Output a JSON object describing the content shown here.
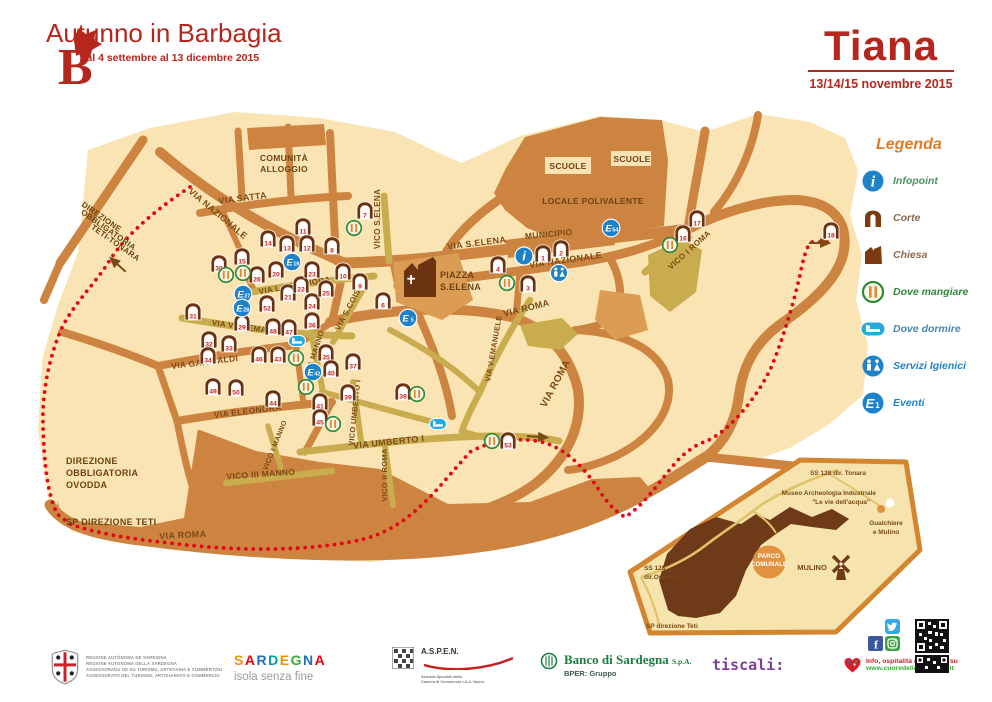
{
  "theme": {
    "red": "#b5261d",
    "map_base": "#fbe4b3",
    "road": "#cd8440",
    "olive": "#c9ac4e",
    "dark_brown": "#6b3310",
    "text_brown": "#7b4a15",
    "boundary": "#e30613",
    "blue": "#1e82c8",
    "light_blue": "#29a8e0",
    "green": "#2e8b3a",
    "utensil": "#e08a2e",
    "legend_orange": "#e07b27",
    "inset_park": "#6e3a17",
    "inset_fill": "#f6e3ae",
    "accent_orange": "#e2923f",
    "number_red": "#cc1f1f"
  },
  "header": {
    "logo_letter": "B",
    "title": "Autunno in Barbagia",
    "subtitle": "dal 4 settembre al 13 dicembre 2015",
    "town": "Tiana",
    "dates": "13/14/15 novembre 2015"
  },
  "legend": {
    "title": "Legenda",
    "items": [
      {
        "id": "infopoint",
        "label": "Infopoint",
        "color": "#4b9464"
      },
      {
        "id": "corte",
        "label": "Corte",
        "color": "#8a6a50"
      },
      {
        "id": "chiesa",
        "label": "Chiesa",
        "color": "#8a6a50"
      },
      {
        "id": "mangiare",
        "label": "Dove mangiare",
        "color": "#2e8b3a"
      },
      {
        "id": "dormire",
        "label": "Dove dormire",
        "color": "#4a86b0"
      },
      {
        "id": "servizi",
        "label": "Servizi Igienici",
        "color": "#1e82c8"
      },
      {
        "id": "eventi",
        "label": "Eventi",
        "color": "#1e82c8"
      }
    ]
  },
  "map": {
    "street_labels": [
      {
        "t": "VIA SATTA",
        "x": 243,
        "y": 201,
        "r": -7,
        "s": 9
      },
      {
        "t": "VIA NAZIONALE",
        "x": 216,
        "y": 216,
        "r": 40,
        "s": 9
      },
      {
        "t": "VIA S.ELENA",
        "x": 477,
        "y": 246,
        "r": -7,
        "s": 9
      },
      {
        "t": "MUNICIPIO",
        "x": 549,
        "y": 237,
        "r": -5,
        "s": 8.5
      },
      {
        "t": "VIA NAZIONALE",
        "x": 566,
        "y": 263,
        "r": -8,
        "s": 9
      },
      {
        "t": "VIA ROMA",
        "x": 527,
        "y": 311,
        "r": -14,
        "s": 9
      },
      {
        "t": "VIA ROMA",
        "x": 558,
        "y": 385,
        "r": -62,
        "s": 10
      },
      {
        "t": "VIA ROMA",
        "x": 183,
        "y": 538,
        "r": -3,
        "s": 9
      },
      {
        "t": "VIA LAMARMORA",
        "x": 295,
        "y": 288,
        "r": -10,
        "s": 8
      },
      {
        "t": "VIA VITT.EMANUELE",
        "x": 253,
        "y": 331,
        "r": 8,
        "s": 8
      },
      {
        "t": "VIA S.COIS",
        "x": 350,
        "y": 311,
        "r": -62,
        "s": 8
      },
      {
        "t": "VIA GARIBALDI",
        "x": 205,
        "y": 365,
        "r": -7,
        "s": 8.5
      },
      {
        "t": "VIA ELEONORA",
        "x": 248,
        "y": 414,
        "r": -7,
        "s": 8.5
      },
      {
        "t": "VIA UMBERTO I",
        "x": 389,
        "y": 445,
        "r": -6,
        "s": 9
      },
      {
        "t": "VICO III MANNO",
        "x": 261,
        "y": 477,
        "r": -4,
        "s": 8.5
      },
      {
        "t": "VICO II ROMA",
        "x": 387,
        "y": 475,
        "r": -90,
        "s": 7.5
      },
      {
        "t": "VICO UMBERTO I",
        "x": 357,
        "y": 413,
        "r": -84,
        "s": 7.5
      },
      {
        "t": "VIA MANNO",
        "x": 317,
        "y": 353,
        "r": -72,
        "s": 7.5
      },
      {
        "t": "VICO I MANNO",
        "x": 277,
        "y": 446,
        "r": -68,
        "s": 7
      },
      {
        "t": "VICO S.ELENA",
        "x": 380,
        "y": 219,
        "r": -90,
        "s": 8
      },
      {
        "t": "VIA V.EMANUELE",
        "x": 496,
        "y": 349,
        "r": -80,
        "s": 7.5
      },
      {
        "t": "VICO I ROMA",
        "x": 691,
        "y": 252,
        "r": -42,
        "s": 8
      }
    ],
    "area_labels": [
      {
        "t": "COMUNITÀ",
        "x": 284,
        "y": 161,
        "s": 8.5
      },
      {
        "t": "ALLOGGIO",
        "x": 284,
        "y": 172,
        "s": 8.5
      },
      {
        "t": "SCUOLE",
        "x": 568,
        "y": 169,
        "s": 8.5
      },
      {
        "t": "SCUOLE",
        "x": 632,
        "y": 162,
        "s": 8.5
      },
      {
        "t": "LOCALE POLIVALENTE",
        "x": 593,
        "y": 204,
        "s": 8.5
      },
      {
        "t": "PIAZZA",
        "x": 440,
        "y": 278,
        "s": 9,
        "a": "start"
      },
      {
        "t": "S.ELENA",
        "x": 440,
        "y": 290,
        "s": 9,
        "a": "start"
      },
      {
        "t": "DIREZIONE",
        "x": 100,
        "y": 219,
        "s": 8,
        "r": 35
      },
      {
        "t": "OBBLIGATORIA",
        "x": 107,
        "y": 232,
        "s": 8,
        "r": 35
      },
      {
        "t": "TETI-TONARA",
        "x": 114,
        "y": 245,
        "s": 8,
        "r": 35
      },
      {
        "t": "DIREZIONE",
        "x": 66,
        "y": 464,
        "s": 9,
        "a": "start"
      },
      {
        "t": "OBBLIGATORIA",
        "x": 66,
        "y": 476,
        "s": 9,
        "a": "start"
      },
      {
        "t": "OVODDA",
        "x": 66,
        "y": 488,
        "s": 9,
        "a": "start"
      },
      {
        "t": "SP DIREZIONE TETI",
        "x": 66,
        "y": 525,
        "s": 9,
        "a": "start"
      }
    ],
    "corte": [
      {
        "n": "1",
        "x": 543,
        "y": 253
      },
      {
        "n": "2",
        "x": 561,
        "y": 248
      },
      {
        "n": "3",
        "x": 528,
        "y": 283
      },
      {
        "n": "4",
        "x": 498,
        "y": 264
      },
      {
        "n": "6",
        "x": 383,
        "y": 300
      },
      {
        "n": "7",
        "x": 365,
        "y": 210
      },
      {
        "n": "8",
        "x": 332,
        "y": 245
      },
      {
        "n": "9",
        "x": 360,
        "y": 281
      },
      {
        "n": "10",
        "x": 343,
        "y": 271
      },
      {
        "n": "11",
        "x": 303,
        "y": 226
      },
      {
        "n": "12",
        "x": 307,
        "y": 243
      },
      {
        "n": "13",
        "x": 287,
        "y": 243
      },
      {
        "n": "14",
        "x": 268,
        "y": 238
      },
      {
        "n": "15",
        "x": 242,
        "y": 256
      },
      {
        "n": "16",
        "x": 683,
        "y": 233
      },
      {
        "n": "17",
        "x": 697,
        "y": 218
      },
      {
        "n": "18",
        "x": 831,
        "y": 230
      },
      {
        "n": "20",
        "x": 276,
        "y": 269
      },
      {
        "n": "21",
        "x": 288,
        "y": 292
      },
      {
        "n": "22",
        "x": 301,
        "y": 284
      },
      {
        "n": "23",
        "x": 312,
        "y": 269
      },
      {
        "n": "24",
        "x": 312,
        "y": 301
      },
      {
        "n": "25",
        "x": 326,
        "y": 288
      },
      {
        "n": "26",
        "x": 257,
        "y": 274
      },
      {
        "n": "29",
        "x": 242,
        "y": 322
      },
      {
        "n": "30",
        "x": 219,
        "y": 263
      },
      {
        "n": "31",
        "x": 193,
        "y": 311
      },
      {
        "n": "32",
        "x": 209,
        "y": 339
      },
      {
        "n": "33",
        "x": 229,
        "y": 343
      },
      {
        "n": "34",
        "x": 208,
        "y": 355
      },
      {
        "n": "35",
        "x": 326,
        "y": 352
      },
      {
        "n": "36",
        "x": 312,
        "y": 320
      },
      {
        "n": "37",
        "x": 353,
        "y": 361
      },
      {
        "n": "38",
        "x": 403,
        "y": 391
      },
      {
        "n": "39",
        "x": 348,
        "y": 392
      },
      {
        "n": "40",
        "x": 331,
        "y": 368
      },
      {
        "n": "41",
        "x": 320,
        "y": 401
      },
      {
        "n": "43",
        "x": 278,
        "y": 354
      },
      {
        "n": "44",
        "x": 273,
        "y": 398
      },
      {
        "n": "45",
        "x": 320,
        "y": 417
      },
      {
        "n": "46",
        "x": 259,
        "y": 354
      },
      {
        "n": "47",
        "x": 289,
        "y": 327
      },
      {
        "n": "48",
        "x": 273,
        "y": 326
      },
      {
        "n": "49",
        "x": 213,
        "y": 386
      },
      {
        "n": "50",
        "x": 236,
        "y": 387
      },
      {
        "n": "52",
        "x": 267,
        "y": 303
      },
      {
        "n": "53",
        "x": 508,
        "y": 440
      }
    ],
    "events": [
      {
        "n": "5",
        "x": 408,
        "y": 318
      },
      {
        "n": "19",
        "x": 292,
        "y": 262
      },
      {
        "n": "27",
        "x": 243,
        "y": 294
      },
      {
        "n": "28",
        "x": 242,
        "y": 308
      },
      {
        "n": "42",
        "x": 313,
        "y": 372
      },
      {
        "n": "54",
        "x": 611,
        "y": 228
      }
    ],
    "eat": [
      {
        "x": 354,
        "y": 228
      },
      {
        "x": 226,
        "y": 275
      },
      {
        "x": 243,
        "y": 273
      },
      {
        "x": 507,
        "y": 283
      },
      {
        "x": 296,
        "y": 358
      },
      {
        "x": 306,
        "y": 387
      },
      {
        "x": 333,
        "y": 424
      },
      {
        "x": 417,
        "y": 394
      },
      {
        "x": 492,
        "y": 441
      },
      {
        "x": 670,
        "y": 245
      }
    ],
    "sleep": [
      {
        "x": 297,
        "y": 341
      },
      {
        "x": 438,
        "y": 424
      }
    ],
    "wc": [
      {
        "x": 559,
        "y": 273
      }
    ],
    "info": [
      {
        "x": 524,
        "y": 256
      }
    ]
  },
  "inset": {
    "labels": [
      {
        "t": "SS 128 dir. Tonara",
        "x": 838,
        "y": 475,
        "s": 6.5
      },
      {
        "t": "Museo Archeologia Industriale",
        "x": 876,
        "y": 495,
        "s": 6.5,
        "a": "end"
      },
      {
        "t": "\"Le vie dell'acqua\"",
        "x": 870,
        "y": 504,
        "s": 6.5,
        "a": "end"
      },
      {
        "t": "Gualchiere",
        "x": 886,
        "y": 525,
        "s": 6.5
      },
      {
        "t": "e Mulino",
        "x": 886,
        "y": 534,
        "s": 6.5
      },
      {
        "t": "MULINO",
        "x": 812,
        "y": 570,
        "s": 7.5
      },
      {
        "t": "SS 128",
        "x": 644,
        "y": 570,
        "s": 6.5,
        "a": "start"
      },
      {
        "t": "dir.Ovodda",
        "x": 644,
        "y": 579,
        "s": 6.5,
        "a": "start"
      },
      {
        "t": "SP direzione Teti",
        "x": 646,
        "y": 628,
        "s": 6.5,
        "a": "start"
      }
    ],
    "parco": {
      "x": 769,
      "y": 560,
      "line1": "PARCO",
      "line2": "COMUNALE"
    }
  },
  "footer": {
    "regione_lines": [
      "REGIONE AUTÒNOMA DE SARDIGNA",
      "REGIONE AUTONOMA DELLA SARDEGNA",
      "ASSESSORADU DE SU TURISMU, ARTESANIA E CUMMÈRTZIU",
      "ASSESSORATO DEL TURISMO, ARTIGIANATO E COMMERCIO"
    ],
    "sardegna": {
      "letters": [
        {
          "c": "S",
          "color": "#f39200"
        },
        {
          "c": "A",
          "color": "#e30613"
        },
        {
          "c": "R",
          "color": "#1d70b7"
        },
        {
          "c": "D",
          "color": "#00a19a"
        },
        {
          "c": "E",
          "color": "#f39200"
        },
        {
          "c": "G",
          "color": "#3aaa35"
        },
        {
          "c": "N",
          "color": "#1d70b7"
        },
        {
          "c": "A",
          "color": "#e30613"
        }
      ],
      "tagline": "isola senza fine"
    },
    "aspen": {
      "name": "A.S.P.E.N.",
      "sub": [
        "Azienda Speciale della",
        "Camera di Commercio I.A.A. Nuoro"
      ]
    },
    "banco": {
      "name": "Banco di Sardegna",
      "spa": "S.p.A.",
      "group": "BPER: Gruppo"
    },
    "tiscali": "tiscali:",
    "info": {
      "line1": "Info, ospitalità e concorsi su",
      "line2": "www.cuoredellasardegna.it"
    }
  }
}
